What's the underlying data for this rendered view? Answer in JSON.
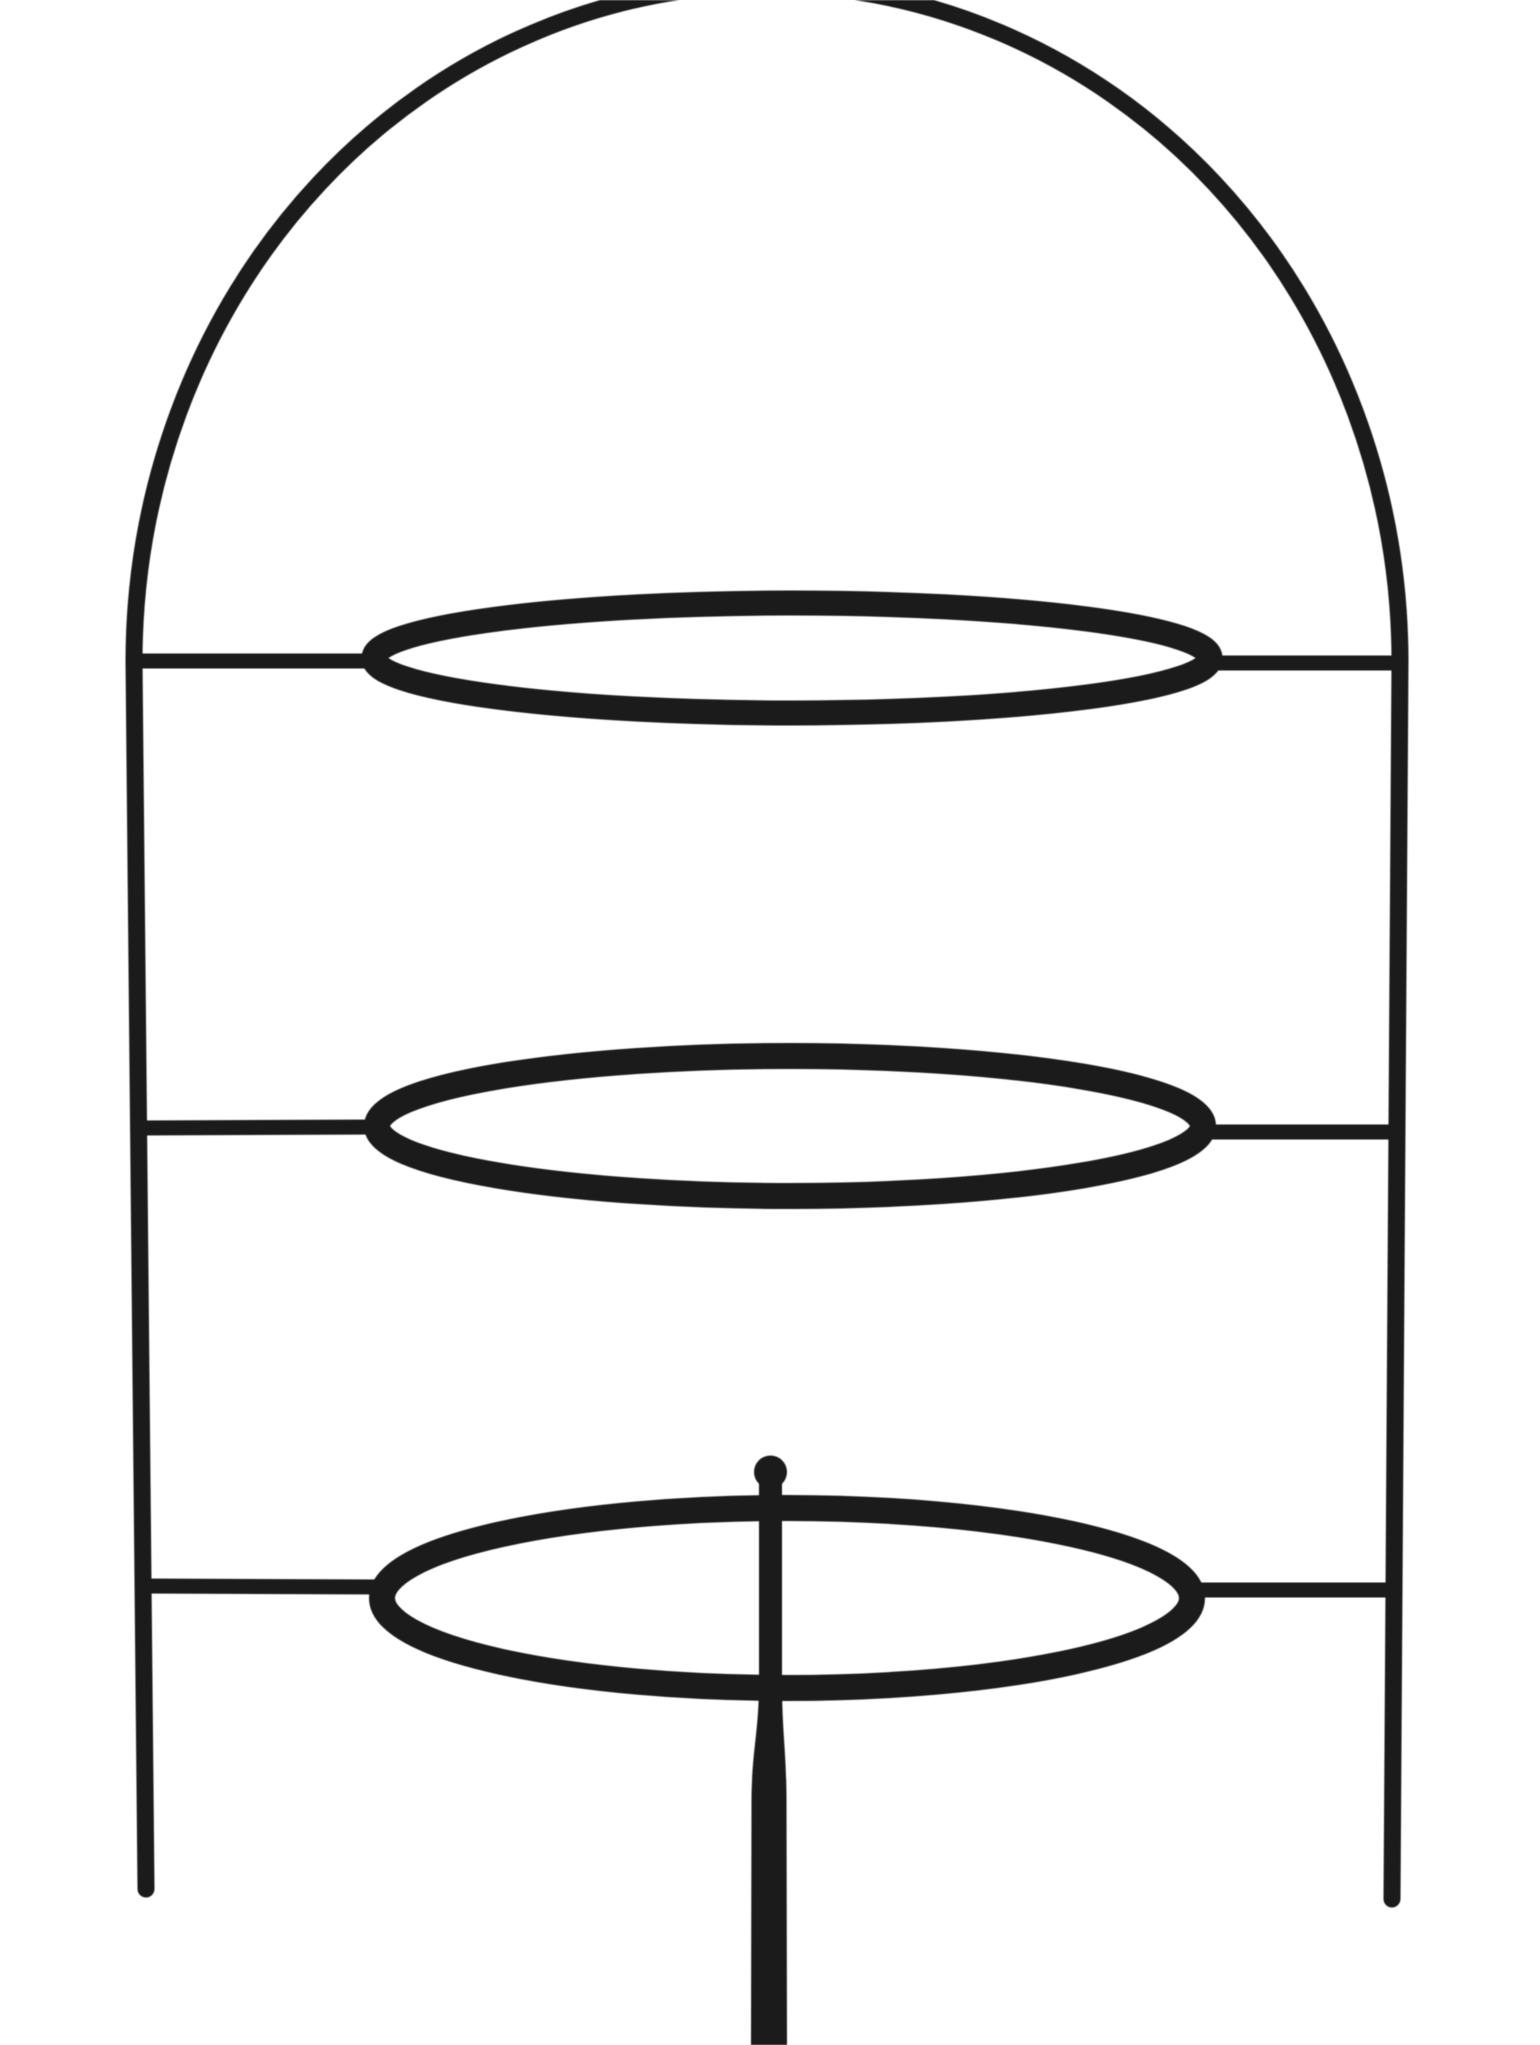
{
  "meta": {
    "content_type": "product-photograph",
    "subject": "three-tier black metal plate stand (etagere) on seamless white background",
    "tier_count": 3,
    "background_color": "#ffffff",
    "wire_color": "#1b1b1b"
  },
  "figure": {
    "viewBox": "0 0 1540 2045",
    "shapes": [
      {
        "type": "path",
        "name": "arch-frame",
        "d": "M 134 662 A 633 677 0 0 1 1400 662",
        "stroke_width": 17,
        "cap": "round"
      },
      {
        "type": "line",
        "name": "left-leg",
        "x1": 134,
        "y1": 660,
        "x2": 146,
        "y2": 1889,
        "stroke_width": 17,
        "cap": "round"
      },
      {
        "type": "line",
        "name": "right-leg",
        "x1": 1400,
        "y1": 660,
        "x2": 1392,
        "y2": 1899,
        "stroke_width": 17,
        "cap": "round"
      },
      {
        "type": "line",
        "name": "tier1-left-support-bar",
        "x1": 134,
        "y1": 661,
        "x2": 384,
        "y2": 661,
        "stroke_width": 15,
        "cap": "butt"
      },
      {
        "type": "line",
        "name": "tier1-right-support-bar",
        "x1": 1200,
        "y1": 663,
        "x2": 1400,
        "y2": 663,
        "stroke_width": 15,
        "cap": "butt"
      },
      {
        "type": "line",
        "name": "tier2-left-support-bar",
        "x1": 137,
        "y1": 1128,
        "x2": 387,
        "y2": 1127,
        "stroke_width": 15,
        "cap": "butt"
      },
      {
        "type": "line",
        "name": "tier2-right-support-bar",
        "x1": 1193,
        "y1": 1132,
        "x2": 1397,
        "y2": 1132,
        "stroke_width": 15,
        "cap": "butt"
      },
      {
        "type": "line",
        "name": "tier3-left-support-bar",
        "x1": 142,
        "y1": 1586,
        "x2": 392,
        "y2": 1587,
        "stroke_width": 15,
        "cap": "butt"
      },
      {
        "type": "line",
        "name": "tier3-right-support-bar",
        "x1": 1183,
        "y1": 1590,
        "x2": 1394,
        "y2": 1590,
        "stroke_width": 15,
        "cap": "butt"
      },
      {
        "type": "path",
        "name": "center-rod",
        "d": "M 759 1470 L 759 1680 C 759 1732 752.5 1746 751.5 1796 L 751 2045 L 787 2045 L 786.5 1796 C 786 1746 782 1732 782 1680 L 782 1470 Z",
        "fill": true
      },
      {
        "type": "circle",
        "name": "center-rod-cap",
        "cx": 770.5,
        "cy": 1472,
        "r": 16.5,
        "fill": true
      },
      {
        "type": "ellipse",
        "name": "tier1-plate-ring",
        "cx": 792,
        "cy": 658,
        "rx": 418,
        "ry": 55,
        "stroke_width": 25
      },
      {
        "type": "ellipse",
        "name": "tier2-plate-ring",
        "cx": 790,
        "cy": 1126,
        "rx": 413,
        "ry": 70,
        "stroke_width": 26
      },
      {
        "type": "ellipse",
        "name": "tier3-plate-ring",
        "cx": 787,
        "cy": 1598,
        "rx": 405,
        "ry": 90,
        "stroke_width": 26
      }
    ]
  }
}
